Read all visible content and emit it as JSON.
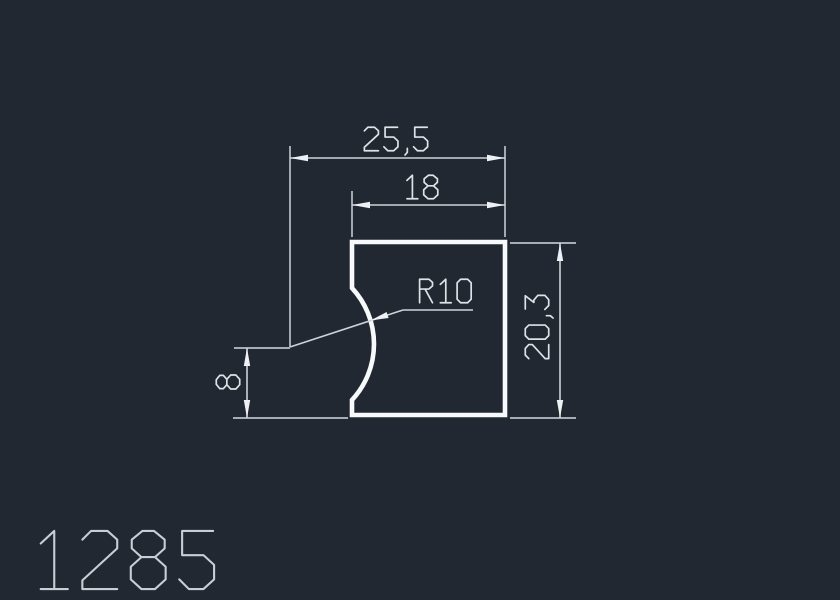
{
  "drawing": {
    "part_number": "1285",
    "dimensions": {
      "overall_width": "25,5",
      "top_width": "18",
      "right_height": "20,3",
      "left_height": "8",
      "radius": "R10"
    }
  },
  "colors": {
    "background": "#212832",
    "profile_stroke": "#f7f9fa",
    "extension_lines": "#b9c0c7",
    "dimension_lines": "#ccd3d8",
    "arrowheads": "#eef1f3",
    "dimension_text": "#dee2e6",
    "part_number_text": "#c9ced4"
  }
}
